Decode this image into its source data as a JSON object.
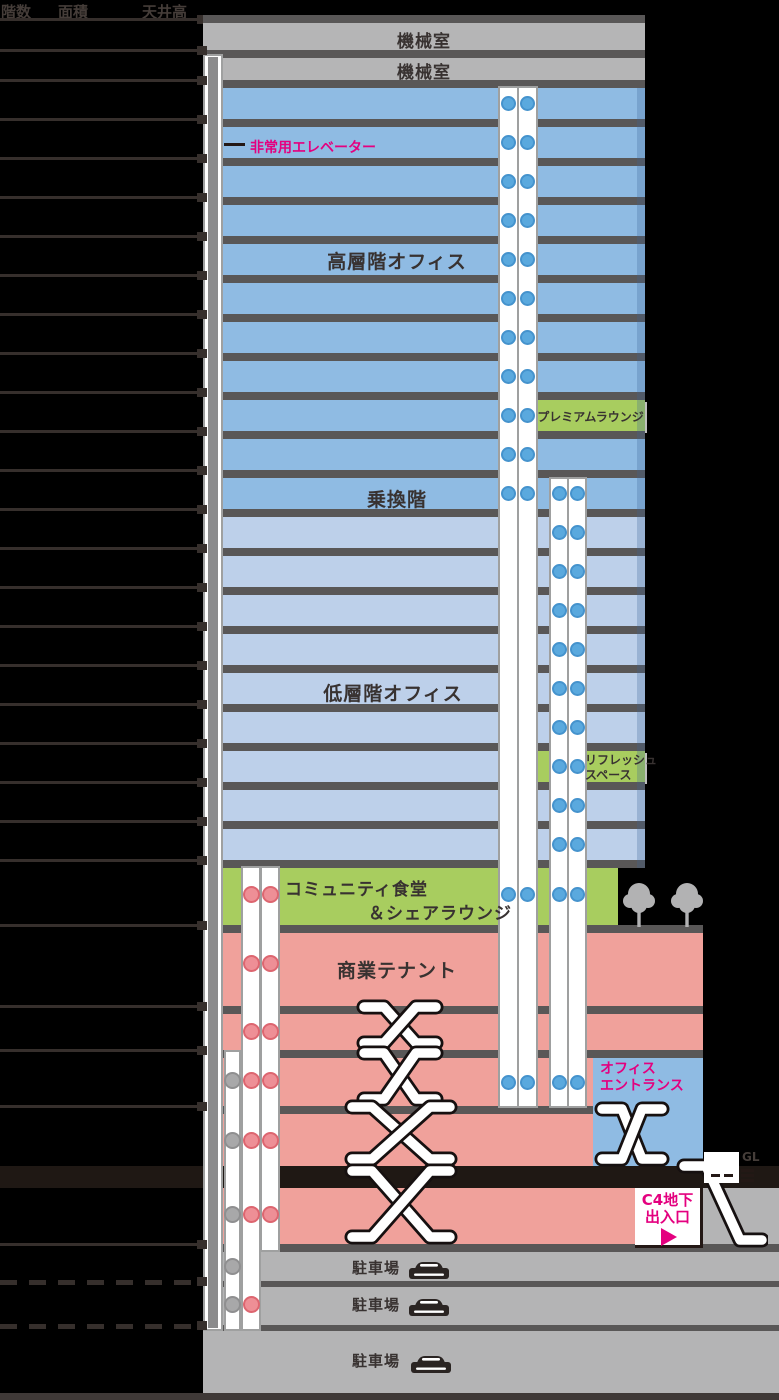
{
  "header": {
    "floor_col": "階数",
    "area_col": "面積",
    "height_col": "天井高"
  },
  "floors": [
    {
      "label": "27F",
      "area": "",
      "ceiling": ""
    },
    {
      "label": "26F",
      "area": "",
      "ceiling": ""
    },
    {
      "label": "25F",
      "area": "963.20m²",
      "ceiling": "3.0m"
    },
    {
      "label": "24F",
      "area": "963.20m²",
      "ceiling": "3.0m"
    },
    {
      "label": "23F",
      "area": "963.20m²",
      "ceiling": "3.0m"
    },
    {
      "label": "22F",
      "area": "963.20m²",
      "ceiling": "3.0m"
    },
    {
      "label": "21F",
      "area": "963.20m²",
      "ceiling": "3.0m"
    },
    {
      "label": "20F",
      "area": "963.20m²",
      "ceiling": "3.0m"
    },
    {
      "label": "19F",
      "area": "963.20m²",
      "ceiling": "3.0m"
    },
    {
      "label": "18F",
      "area": "963.20m²",
      "ceiling": "3.0m"
    },
    {
      "label": "17F",
      "area": "553.18m²",
      "ceiling": "3.0m"
    },
    {
      "label": "16F",
      "area": "963.20m²",
      "ceiling": "3.0m"
    },
    {
      "label": "15F",
      "area": "861.87m²",
      "ceiling": "3.0m"
    },
    {
      "label": "14F",
      "area": "963.20m²",
      "ceiling": "3.0m"
    },
    {
      "label": "13F",
      "area": "963.20m²",
      "ceiling": "3.0m"
    },
    {
      "label": "12F",
      "area": "963.20m²",
      "ceiling": "3.0m"
    },
    {
      "label": "11F",
      "area": "963.20m²",
      "ceiling": "3.0m"
    },
    {
      "label": "10F",
      "area": "963.20m²",
      "ceiling": "3.0m"
    },
    {
      "label": "9F",
      "area": "963.20m²",
      "ceiling": "3.0m"
    },
    {
      "label": "8F",
      "area": "732.46m²",
      "ceiling": "3.0m"
    },
    {
      "label": "7F",
      "area": "963.20m²",
      "ceiling": "3.0m"
    },
    {
      "label": "6F",
      "area": "963.20m²",
      "ceiling": "3.0m"
    },
    {
      "label": "5F",
      "area": "",
      "ceiling": ""
    },
    {
      "label": "4F",
      "area": "",
      "ceiling": ""
    },
    {
      "label": "3F",
      "area": "",
      "ceiling": ""
    },
    {
      "label": "2F",
      "area": "",
      "ceiling": ""
    },
    {
      "label": "1F",
      "area": "",
      "ceiling": ""
    },
    {
      "label": "B1F",
      "area": "",
      "ceiling": ""
    },
    {
      "label": "B2F",
      "area": "",
      "ceiling": ""
    },
    {
      "label": "B3F",
      "area": "",
      "ceiling": ""
    },
    {
      "label": "B4F",
      "area": "",
      "ceiling": ""
    }
  ],
  "zones": {
    "machine_room_27f": "機械室",
    "machine_room_26f": "機械室",
    "high_rise_office": "高層階オフィス",
    "premium_lounge": "プレミアムラウンジ",
    "transfer_floor": "乗換階",
    "low_rise_office": "低層階オフィス",
    "refresh_space_line1": "リフレッシュ",
    "refresh_space_line2": "スペース",
    "community_dining_line1": "コミュニティ食堂",
    "community_dining_line2": "＆シェアラウンジ",
    "commercial_tenant": "商業テナント",
    "office_entrance_line1": "オフィス",
    "office_entrance_line2": "エントランス",
    "parking": "駐車場",
    "emergency_elevator": "非常用エレベーター",
    "c4_exit_line1": "C4地下",
    "c4_exit_line2": "出入口",
    "gl": "GL"
  },
  "colors": {
    "accent_magenta": "#e4007f",
    "high_rise_blue": "#8fbbe3",
    "low_rise_blue": "#bdd0ea",
    "green_amenity": "#a8cd5f",
    "commercial_pink": "#f0a19b",
    "machine_room_gray": "#b5b5b6",
    "parking_gray": "#b4b4b5",
    "slab_gray": "#595757",
    "ground_line_black": "#1f1814",
    "elevator_blue_dot": "#5aa9de",
    "elevator_pink_dot": "#ee8f96",
    "elevator_gray_dot": "#a8a8a9"
  }
}
